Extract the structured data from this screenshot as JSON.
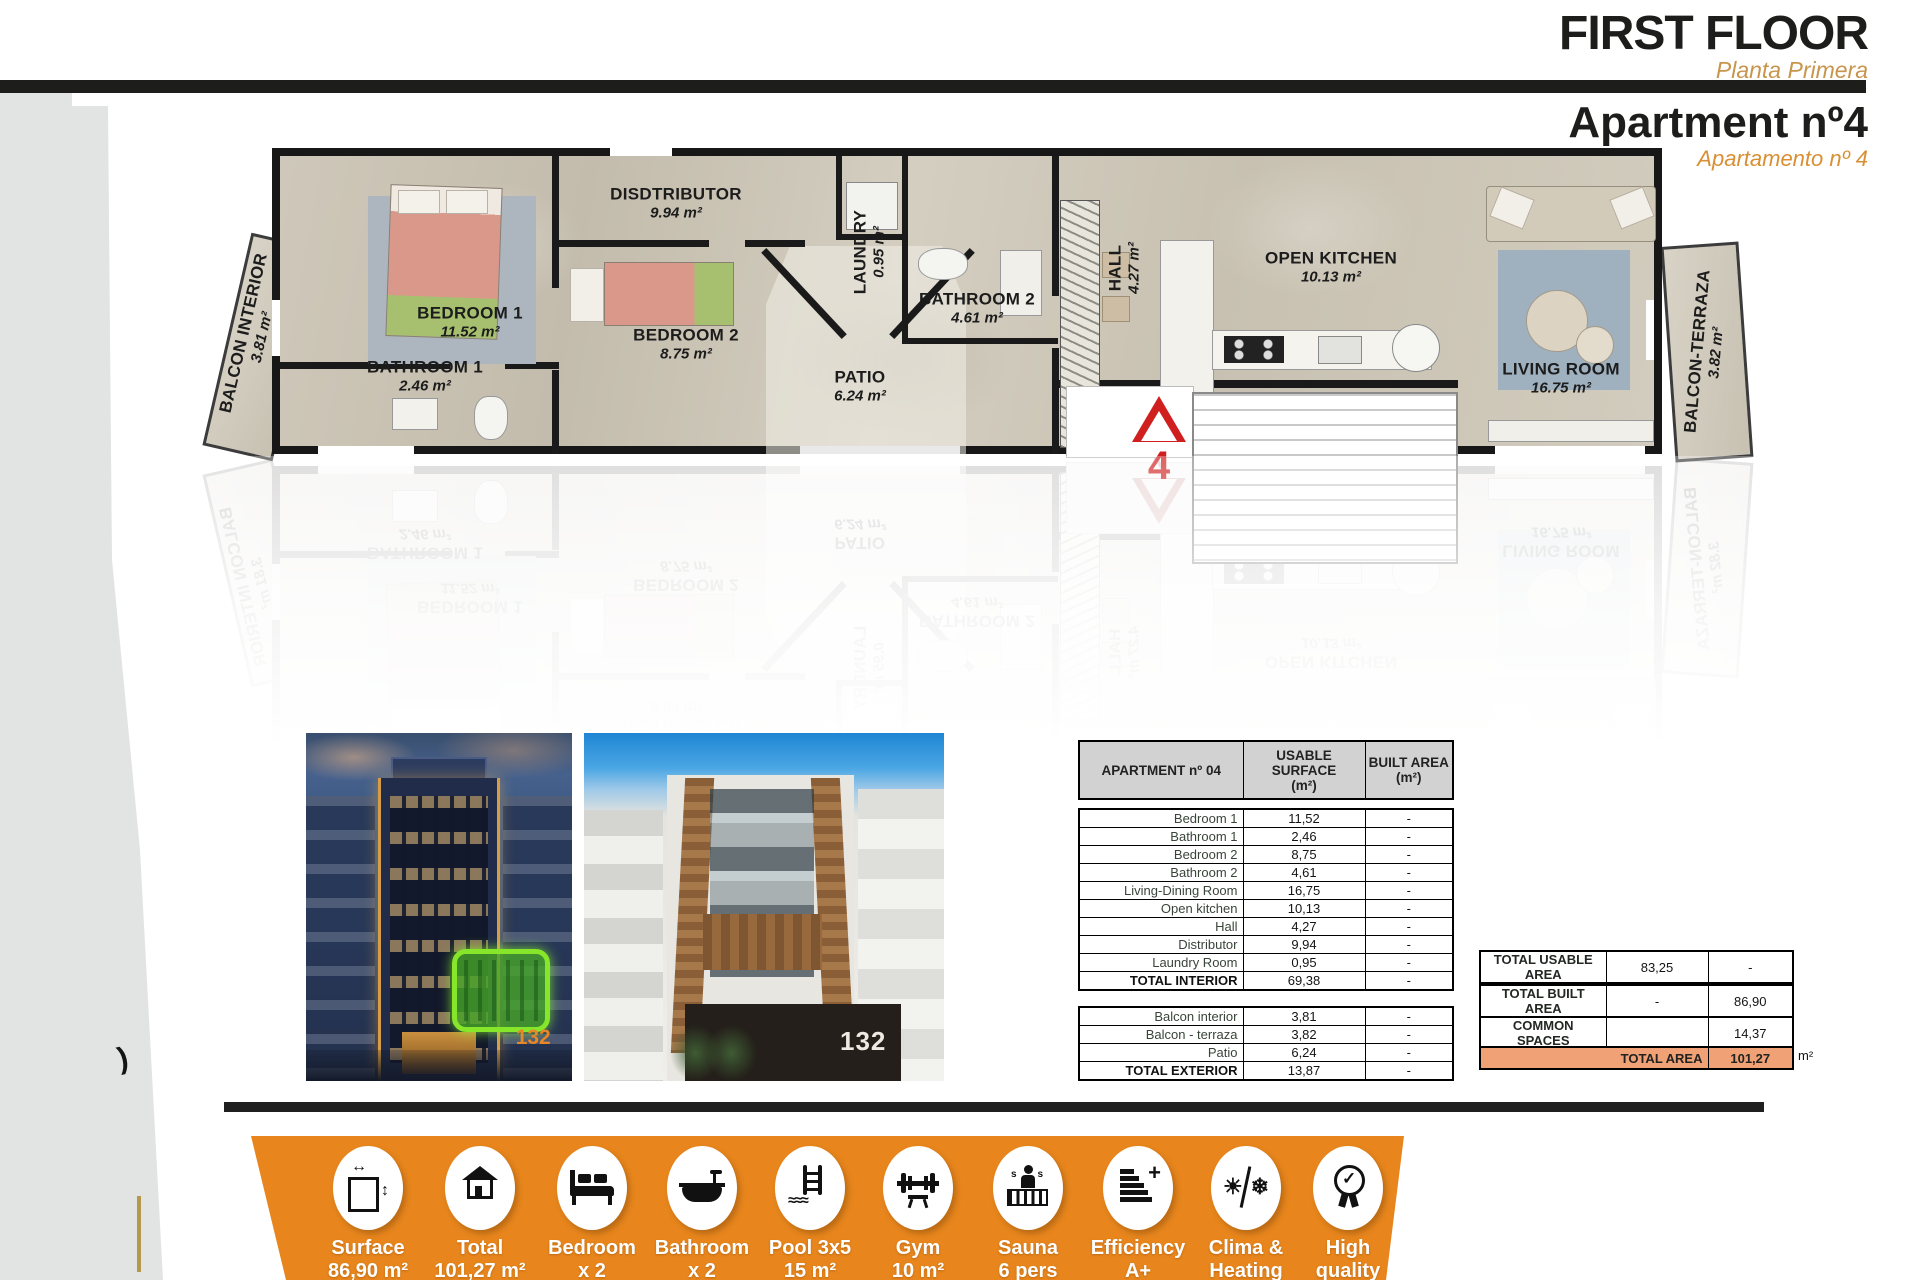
{
  "colors": {
    "accent_orange": "#e8861d",
    "salmon_row": "#f0a276",
    "gold_subtitle": "#c8954d",
    "unit_red": "#cf1f1f"
  },
  "decor": {
    "paren_mark": ")"
  },
  "header": {
    "title": "FIRST FLOOR",
    "subtitle": "Planta Primera",
    "apartment_title": "Apartment nº4",
    "apartment_subtitle": "Apartamento nº 4"
  },
  "floorplan": {
    "unit_number": "4",
    "rooms": [
      {
        "name": "BALCON INTERIOR",
        "area": "3.81 m²"
      },
      {
        "name": "BEDROOM 1",
        "area": "11.52 m²"
      },
      {
        "name": "BATHROOM 1",
        "area": "2.46 m²"
      },
      {
        "name": "DISDTRIBUTOR",
        "area": "9.94 m²"
      },
      {
        "name": "BEDROOM 2",
        "area": "8.75 m²"
      },
      {
        "name": "LAUNDRY",
        "area": "0.95 m²"
      },
      {
        "name": "PATIO",
        "area": "6.24 m²"
      },
      {
        "name": "BATHROOM 2",
        "area": "4.61 m²"
      },
      {
        "name": "HALL",
        "area": "4.27 m²"
      },
      {
        "name": "OPEN KITCHEN",
        "area": "10.13 m²"
      },
      {
        "name": "LIVING ROOM",
        "area": "16.75 m²"
      },
      {
        "name": "BALCON-TERRAZA",
        "area": "3.82 m²"
      }
    ]
  },
  "photos": {
    "night_number": "132",
    "day_number": "132"
  },
  "surface_table": {
    "col1": "APARTMENT nº 04",
    "col2": "USABLE SURFACE\n(m²)",
    "col3": "BUILT AREA\n(m²)",
    "interior": [
      {
        "name": "Bedroom 1",
        "usable": "11,52",
        "built": "-"
      },
      {
        "name": "Bathroom 1",
        "usable": "2,46",
        "built": "-"
      },
      {
        "name": "Bedroom 2",
        "usable": "8,75",
        "built": "-"
      },
      {
        "name": "Bathroom 2",
        "usable": "4,61",
        "built": "-"
      },
      {
        "name": "Living-Dining Room",
        "usable": "16,75",
        "built": "-"
      },
      {
        "name": "Open kitchen",
        "usable": "10,13",
        "built": "-"
      },
      {
        "name": "Hall",
        "usable": "4,27",
        "built": "-"
      },
      {
        "name": "Distributor",
        "usable": "9,94",
        "built": "-"
      },
      {
        "name": "Laundry Room",
        "usable": "0,95",
        "built": "-"
      },
      {
        "name": "TOTAL INTERIOR",
        "usable": "69,38",
        "built": "-"
      }
    ],
    "exterior": [
      {
        "name": "Balcon interior",
        "usable": "3,81",
        "built": "-"
      },
      {
        "name": "Balcon - terraza",
        "usable": "3,82",
        "built": "-"
      },
      {
        "name": "Patio",
        "usable": "6,24",
        "built": "-"
      },
      {
        "name": "TOTAL EXTERIOR",
        "usable": "13,87",
        "built": "-"
      }
    ]
  },
  "totals": {
    "usable": {
      "label": "TOTAL USABLE AREA",
      "usable": "83,25",
      "built": "-"
    },
    "built": {
      "label": "TOTAL BUILT AREA",
      "usable": "-",
      "built": "86,90"
    },
    "common": {
      "label": "COMMON SPACES",
      "usable": "",
      "built": "14,37"
    },
    "total": {
      "label": "TOTAL AREA",
      "value": "101,27",
      "unit": "m²"
    }
  },
  "features": [
    {
      "line1": "Surface",
      "line2": "86,90 m²"
    },
    {
      "line1": "Total",
      "line2": "101,27 m²"
    },
    {
      "line1": "Bedroom",
      "line2": "x 2"
    },
    {
      "line1": "Bathroom",
      "line2": "x 2"
    },
    {
      "line1": "Pool 3x5",
      "line2": "15 m²"
    },
    {
      "line1": "Gym",
      "line2": "10 m²"
    },
    {
      "line1": "Sauna",
      "line2": "6 pers"
    },
    {
      "line1": "Efficiency",
      "line2": "A+"
    },
    {
      "line1": "Clima &",
      "line2": "Heating"
    },
    {
      "line1": "High",
      "line2": "quality"
    }
  ]
}
